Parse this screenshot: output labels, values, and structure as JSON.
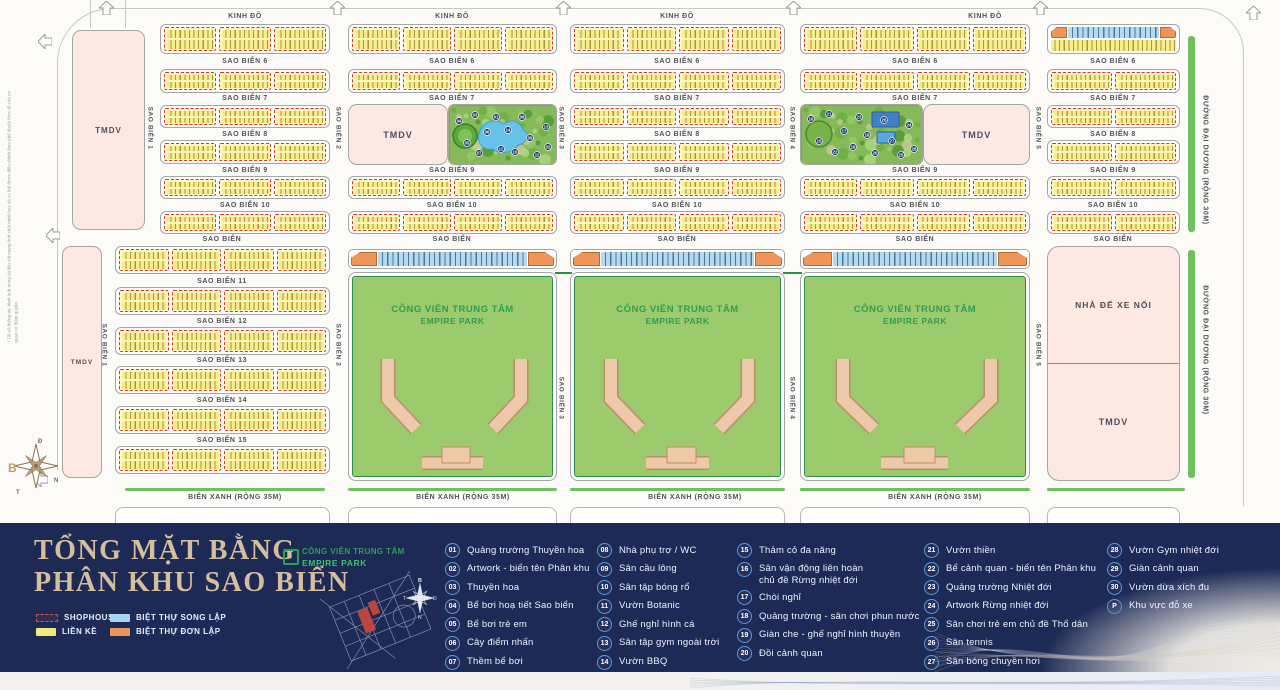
{
  "map": {
    "top_road": "KINH ĐÔ",
    "h_roads": [
      "SAO BIỂN 6",
      "SAO BIỂN 7",
      "SAO BIỂN 8",
      "SAO BIỂN 9",
      "SAO BIỂN 10",
      "SAO BIỂN"
    ],
    "lower_roads": [
      "SAO BIỂN 11",
      "SAO BIỂN 12",
      "SAO BIỂN 13",
      "SAO BIỂN 14",
      "SAO BIỂN 15"
    ],
    "v_roads": [
      "SAO BIỂN 1",
      "SAO BIỂN 2",
      "SAO BIỂN 3",
      "SAO BIỂN 4",
      "SAO BIỂN 5"
    ],
    "right_road": "ĐƯỜNG ĐẠI DƯƠNG (RỘNG 30M)",
    "bottom_road": "BIỂN XANH (RỘNG 35M)",
    "park_line1": "CÔNG VIÊN TRUNG TÂM",
    "park_line2": "EMPIRE PARK",
    "tmdv_label": "TMDV",
    "parking_label": "NHÀ ĐỂ XE NỔI",
    "compass": {
      "north": "B",
      "east": "Đ",
      "south": "N",
      "west": "T"
    },
    "disclaimer": "* Tất cả thông tin, hình ảnh trong tài liệu chỉ mang tính chất minh họa và có thể được điều chỉnh theo phê duyệt thực tế của cơ quan có thẩm quyền."
  },
  "legend": {
    "title_line1": "TỔNG MẶT BẰNG",
    "title_line2": "PHÂN KHU SAO BIỂN",
    "swatches": [
      {
        "label": "SHOPHOUSE",
        "type": "shophouse",
        "color": "#d5372c"
      },
      {
        "label": "LIỀN KỀ",
        "type": "lienke",
        "color": "#f3e87c"
      },
      {
        "label": "BIỆT THỰ SONG LẬP",
        "type": "songlap",
        "color": "#a9d3ee"
      },
      {
        "label": "BIỆT THỰ ĐƠN LẬP",
        "type": "donlap",
        "color": "#ef9559"
      }
    ],
    "park_line1": "CÔNG VIÊN TRUNG TÂM",
    "park_line2": "EMPIRE PARK",
    "items": [
      {
        "n": "01",
        "t": "Quảng trường Thuyền hoa"
      },
      {
        "n": "02",
        "t": "Artwork - biển tên Phân khu"
      },
      {
        "n": "03",
        "t": "Thuyền hoa"
      },
      {
        "n": "04",
        "t": "Bể bơi hoạ tiết Sao biển"
      },
      {
        "n": "05",
        "t": "Bể bơi trẻ em"
      },
      {
        "n": "06",
        "t": "Cây điểm nhấn"
      },
      {
        "n": "07",
        "t": "Thềm bể bơi"
      },
      {
        "n": "08",
        "t": "Nhà phụ trợ / WC"
      },
      {
        "n": "09",
        "t": "Sân cầu lông"
      },
      {
        "n": "10",
        "t": "Sân tập bóng rổ"
      },
      {
        "n": "11",
        "t": "Vườn Botanic"
      },
      {
        "n": "12",
        "t": "Ghế nghỉ hình cá"
      },
      {
        "n": "13",
        "t": "Sân tập gym ngoài trời"
      },
      {
        "n": "14",
        "t": "Vườn BBQ"
      },
      {
        "n": "15",
        "t": "Thảm cỏ đa năng"
      },
      {
        "n": "16",
        "t": "Sân vận động liên hoàn\nchủ đề Rừng nhiệt đới"
      },
      {
        "n": "17",
        "t": "Chòi nghỉ"
      },
      {
        "n": "18",
        "t": "Quảng trường - sân chơi phun nước"
      },
      {
        "n": "19",
        "t": "Giàn che - ghế nghỉ hình thuyền"
      },
      {
        "n": "20",
        "t": "Đồi cảnh quan"
      },
      {
        "n": "21",
        "t": "Vườn thiền"
      },
      {
        "n": "22",
        "t": "Bể cảnh quan - biển tên Phân khu"
      },
      {
        "n": "23",
        "t": "Quảng trường Nhiệt đới"
      },
      {
        "n": "24",
        "t": "Artwork Rừng nhiệt đới"
      },
      {
        "n": "25",
        "t": "Sân chơi trẻ em chủ đề Thổ dân"
      },
      {
        "n": "26",
        "t": "Sân tennis"
      },
      {
        "n": "27",
        "t": "Sân bóng chuyền hơi"
      },
      {
        "n": "28",
        "t": "Vườn Gym nhiệt đới"
      },
      {
        "n": "29",
        "t": "Giàn cảnh quan"
      },
      {
        "n": "30",
        "t": "Vườn dừa xích đu"
      },
      {
        "n": "P",
        "t": "Khu vực đỗ xe"
      }
    ]
  },
  "colors": {
    "band_navy": "#1d2a56",
    "shophouse_red": "#d5372c",
    "lienke_yellow": "#f3e87c",
    "songlap_blue": "#a9d3ee",
    "donlap_orange": "#ef9559",
    "park_green": "#9ccb6e",
    "park_border_green": "#2e8f4d",
    "title_tan": "#d6bd9c",
    "legend_circle_blue": "#5b9bd5"
  }
}
